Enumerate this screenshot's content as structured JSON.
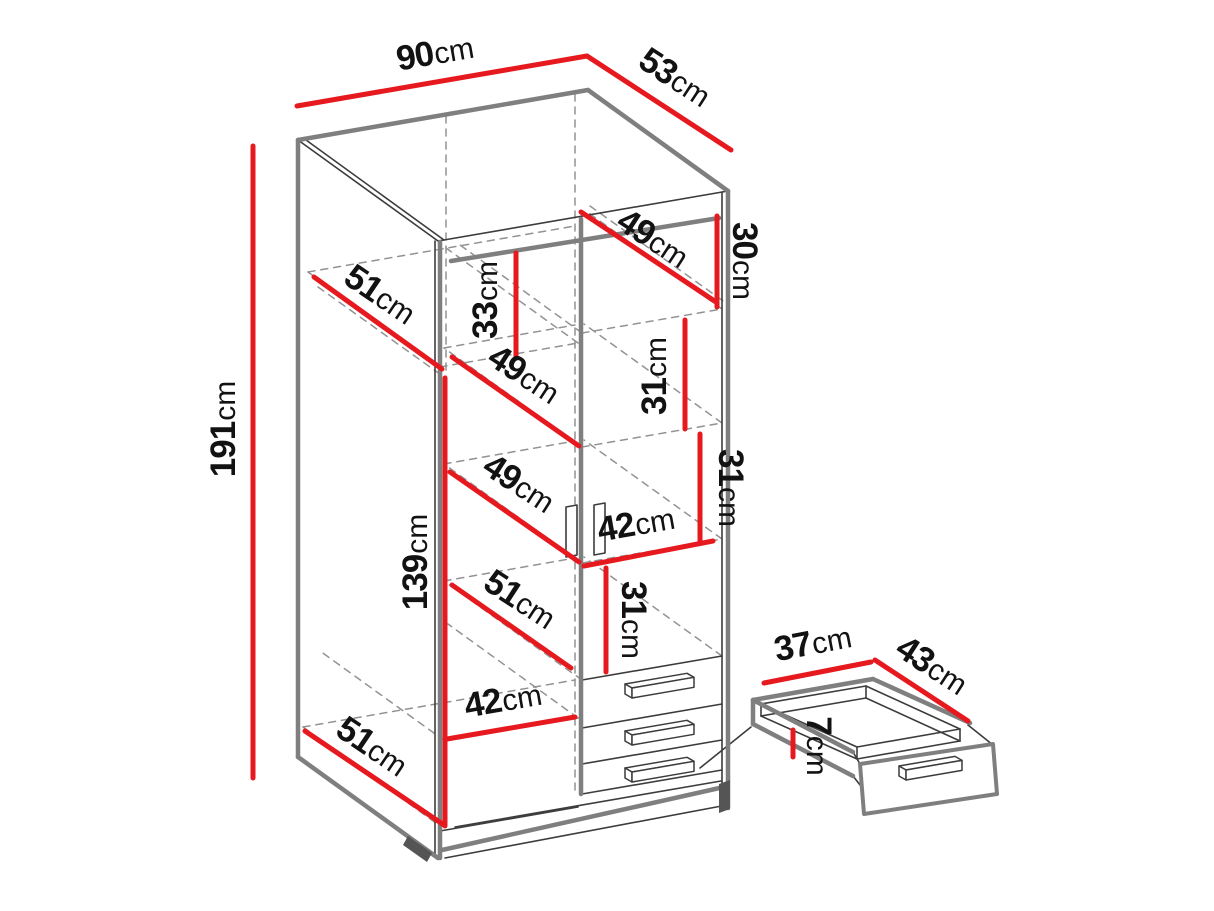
{
  "meta": {
    "description": "Wardrobe dimension diagram with drawer detail",
    "unit": "cm",
    "canvas": {
      "w": 1214,
      "h": 911
    }
  },
  "style": {
    "background": "#ffffff",
    "dimension_color": "#e6191f",
    "outline_color": "#7f7f7f",
    "edge_color": "#3c3c3c",
    "hidden_color": "#929292",
    "text_color": "#121212",
    "foot_color": "#555555"
  },
  "overall": {
    "width": "90cm",
    "depth": "53cm",
    "height": "191cm"
  },
  "dimensions": [
    {
      "id": "width-total",
      "num": "90",
      "unit": "cm",
      "line": [
        297,
        106,
        587,
        56
      ],
      "pos": [
        437,
        64
      ],
      "rot": -10
    },
    {
      "id": "depth-total",
      "num": "53",
      "unit": "cm",
      "line": [
        587,
        56,
        731,
        150
      ],
      "pos": [
        669,
        87
      ],
      "rot": 33
    },
    {
      "id": "height-total",
      "num": "191",
      "unit": "cm",
      "line": [
        253,
        146,
        253,
        778
      ],
      "pos": [
        235,
        429
      ],
      "rot": -90
    },
    {
      "id": "top-shelf-width",
      "num": "49",
      "unit": "cm",
      "line": [
        581,
        212,
        716,
        302
      ],
      "pos": [
        647,
        248
      ],
      "rot": 33
    },
    {
      "id": "top-shelf-height",
      "num": "30",
      "unit": "cm",
      "line": [
        717,
        216,
        717,
        307
      ],
      "pos": [
        733,
        261
      ],
      "rot": 90
    },
    {
      "id": "depth-inner-top",
      "num": "51",
      "unit": "cm",
      "line": [
        314,
        277,
        442,
        369
      ],
      "pos": [
        374,
        304
      ],
      "rot": 34
    },
    {
      "id": "left-gap-height",
      "num": "33",
      "unit": "cm",
      "line": [
        516,
        253,
        516,
        357
      ],
      "pos": [
        497,
        300
      ],
      "rot": -90
    },
    {
      "id": "shelf-width-a",
      "num": "49",
      "unit": "cm",
      "line": [
        452,
        357,
        579,
        446
      ],
      "pos": [
        518,
        384
      ],
      "rot": 33
    },
    {
      "id": "shelf-height-a",
      "num": "31",
      "unit": "cm",
      "line": [
        685,
        320,
        685,
        429
      ],
      "pos": [
        666,
        376
      ],
      "rot": -90
    },
    {
      "id": "shelf-width-b",
      "num": "49",
      "unit": "cm",
      "line": [
        450,
        472,
        579,
        562
      ],
      "pos": [
        513,
        493
      ],
      "rot": 33
    },
    {
      "id": "shelf-height-b",
      "num": "31",
      "unit": "cm",
      "line": [
        700,
        434,
        700,
        542
      ],
      "pos": [
        719,
        488
      ],
      "rot": 90
    },
    {
      "id": "right-col-width",
      "num": "42",
      "unit": "cm",
      "line": [
        584,
        566,
        713,
        541
      ],
      "pos": [
        638,
        535
      ],
      "rot": -10
    },
    {
      "id": "hanging-height",
      "num": "139",
      "unit": "cm",
      "line": [
        445,
        378,
        445,
        826
      ],
      "pos": [
        427,
        562
      ],
      "rot": -90
    },
    {
      "id": "shelf-width-c",
      "num": "51",
      "unit": "cm",
      "line": [
        452,
        585,
        571,
        668
      ],
      "pos": [
        514,
        609
      ],
      "rot": 33
    },
    {
      "id": "shelf-height-c",
      "num": "31",
      "unit": "cm",
      "line": [
        606,
        568,
        606,
        672
      ],
      "pos": [
        622,
        620
      ],
      "rot": 90
    },
    {
      "id": "left-col-width",
      "num": "42",
      "unit": "cm",
      "line": [
        447,
        739,
        575,
        717
      ],
      "pos": [
        505,
        711
      ],
      "rot": -10
    },
    {
      "id": "depth-inner-bottom",
      "num": "51",
      "unit": "cm",
      "line": [
        305,
        731,
        444,
        825
      ],
      "pos": [
        366,
        756
      ],
      "rot": 34
    },
    {
      "id": "drawer-width",
      "num": "37",
      "unit": "cm",
      "line": [
        764,
        683,
        871,
        662
      ],
      "pos": [
        815,
        654
      ],
      "rot": -11
    },
    {
      "id": "drawer-depth",
      "num": "43",
      "unit": "cm",
      "line": [
        875,
        660,
        968,
        721
      ],
      "pos": [
        926,
        675
      ],
      "rot": 33
    },
    {
      "id": "drawer-height",
      "num": "7",
      "unit": "cm",
      "line": [
        793,
        730,
        793,
        757
      ],
      "pos": [
        807,
        746
      ],
      "rot": 90
    }
  ],
  "cabinet": {
    "thick_lines": [
      [
        298,
        140,
        588,
        90
      ],
      [
        588,
        90,
        728,
        191
      ],
      [
        298,
        140,
        298,
        757
      ],
      [
        298,
        757,
        438,
        858
      ],
      [
        728,
        191,
        728,
        808
      ],
      [
        442,
        850,
        724,
        787
      ],
      [
        451,
        261,
        719,
        218
      ],
      [
        440,
        242,
        440,
        858
      ],
      [
        581,
        219,
        581,
        794
      ]
    ],
    "thin_lines": [
      [
        438,
        241,
        728,
        191
      ],
      [
        298,
        140,
        438,
        241
      ],
      [
        306,
        140,
        444,
        240
      ],
      [
        435,
        241,
        435,
        857
      ],
      [
        722,
        192,
        722,
        807
      ],
      [
        440,
        831,
        578,
        807
      ],
      [
        445,
        858,
        727,
        805
      ],
      [
        582,
        680,
        722,
        656
      ],
      [
        582,
        728,
        722,
        704
      ],
      [
        582,
        764,
        722,
        740
      ],
      [
        582,
        794,
        722,
        770
      ],
      [
        455,
        827,
        721,
        781
      ],
      [
        700,
        768,
        751,
        727
      ]
    ],
    "dashed_lines": [
      [
        446,
        116,
        446,
        826
      ],
      [
        575,
        94,
        575,
        792
      ],
      [
        440,
        367,
        578,
        343
      ],
      [
        440,
        367,
        308,
        272
      ],
      [
        578,
        343,
        446,
        248
      ],
      [
        308,
        272,
        575,
        226
      ],
      [
        318,
        287,
        444,
        377
      ],
      [
        582,
        333,
        722,
        309
      ],
      [
        582,
        333,
        460,
        245
      ],
      [
        722,
        309,
        586,
        211
      ],
      [
        590,
        206,
        726,
        303
      ],
      [
        582,
        447,
        722,
        423
      ],
      [
        582,
        447,
        444,
        348
      ],
      [
        722,
        423,
        584,
        324
      ],
      [
        444,
        348,
        575,
        325
      ],
      [
        582,
        563,
        722,
        539
      ],
      [
        582,
        563,
        444,
        464
      ],
      [
        722,
        539,
        584,
        440
      ],
      [
        444,
        464,
        575,
        441
      ],
      [
        582,
        680,
        444,
        581
      ],
      [
        722,
        656,
        584,
        557
      ],
      [
        444,
        581,
        575,
        558
      ],
      [
        445,
        741,
        578,
        718
      ],
      [
        445,
        741,
        320,
        651
      ],
      [
        578,
        718,
        448,
        624
      ],
      [
        303,
        727,
        440,
        826
      ],
      [
        303,
        727,
        575,
        680
      ]
    ],
    "rod_holders": [
      [
        [
          566,
          507
        ],
        [
          577,
          505
        ],
        [
          577,
          555
        ],
        [
          566,
          557
        ]
      ],
      [
        [
          594,
          505
        ],
        [
          605,
          503
        ],
        [
          605,
          553
        ],
        [
          594,
          555
        ]
      ]
    ],
    "feet": [
      [
        [
          408,
          836
        ],
        [
          432,
          853
        ],
        [
          427,
          862
        ],
        [
          403,
          845
        ]
      ],
      [
        [
          719,
          784
        ],
        [
          730,
          780
        ],
        [
          730,
          809
        ],
        [
          719,
          813
        ]
      ]
    ],
    "handles": [
      {
        "x": 632,
        "y": 688,
        "w": 62
      },
      {
        "x": 632,
        "y": 735,
        "w": 62
      },
      {
        "x": 632,
        "y": 772,
        "w": 62
      }
    ]
  },
  "drawer_detail": {
    "thick_lines": [
      [
        753,
        700,
        873,
        679
      ],
      [
        873,
        679,
        970,
        723
      ],
      [
        753,
        700,
        853,
        752
      ],
      [
        753,
        700,
        753,
        724
      ],
      [
        753,
        724,
        853,
        776
      ]
    ],
    "thin_lines": [
      [
        761,
        704,
        866,
        686
      ],
      [
        866,
        686,
        960,
        729
      ],
      [
        960,
        729,
        857,
        747
      ],
      [
        857,
        747,
        761,
        704
      ],
      [
        761,
        716,
        866,
        698
      ],
      [
        866,
        698,
        960,
        741
      ],
      [
        960,
        741,
        857,
        759
      ],
      [
        857,
        759,
        761,
        716
      ],
      [
        761,
        704,
        761,
        716
      ],
      [
        866,
        686,
        866,
        698
      ],
      [
        960,
        729,
        960,
        741
      ],
      [
        857,
        747,
        857,
        759
      ],
      [
        853,
        752,
        860,
        764
      ],
      [
        968,
        725,
        993,
        745
      ],
      [
        853,
        776,
        864,
        790
      ]
    ],
    "front_panel": [
      [
        860,
        764
      ],
      [
        993,
        744
      ],
      [
        997,
        794
      ],
      [
        864,
        814
      ]
    ],
    "handles": [
      {
        "x": 906,
        "y": 770,
        "w": 56
      }
    ]
  }
}
